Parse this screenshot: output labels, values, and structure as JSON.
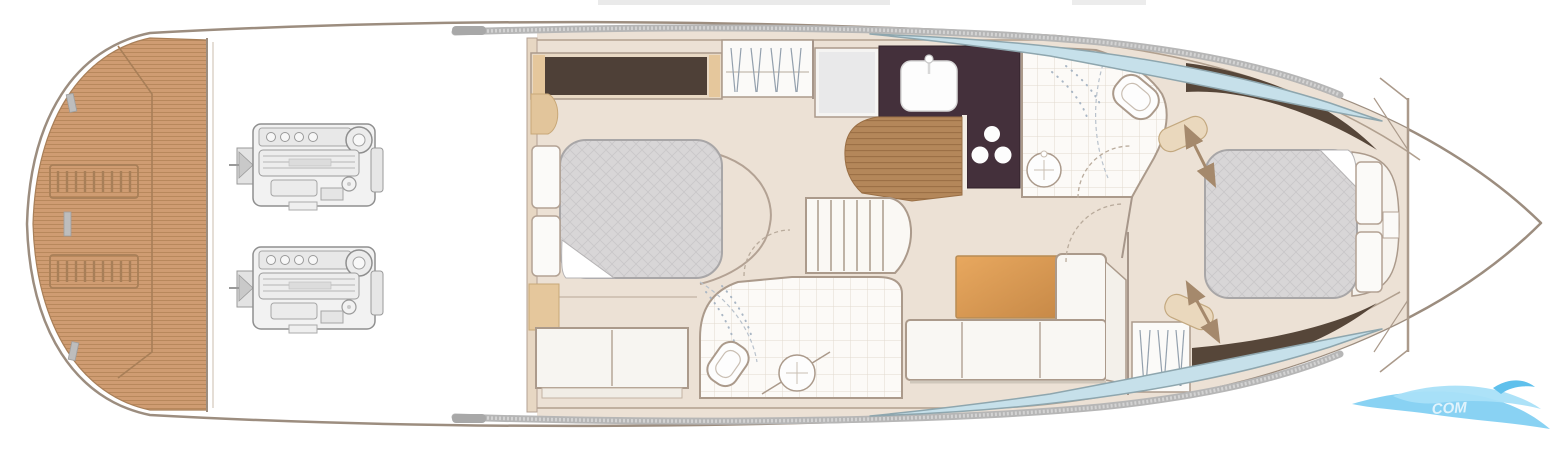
{
  "watermark": {
    "text": "COM"
  },
  "colors": {
    "teak": "#cf9c72",
    "teak_line": "#b8885c",
    "teak_edge": "#a87f58",
    "hull_line": "#9c8d7f",
    "wall": "#a6968a",
    "floor_beige": "#ece1d5",
    "wardrobe_dark": "#4e4037",
    "tan_wood": "#e5c79c",
    "galley_counter": "#44303b",
    "galley_floor": "#b4875a",
    "galley_floor_line": "#9a6f45",
    "mattress": "#d8d6d7",
    "mattress_line": "#c9c7c9",
    "white_furniture": "#fbfaf8",
    "tile_line": "#e2dacf",
    "window_blue": "#c6e0ea",
    "window_edge": "#8ea6ae",
    "rub_rail": "#b6b6b6",
    "table_wood": "#e8a85f",
    "table_wood_dark": "#c78947",
    "wedge_dark": "#564639",
    "arrow": "#a5896c",
    "engine_line": "#8f8f8f",
    "engine_fill": "#f2f2f2",
    "wave_blue": "#7ccdf2",
    "wave_blue_light": "#a9e0f8",
    "wave_blue_dark": "#5fc0ec"
  }
}
